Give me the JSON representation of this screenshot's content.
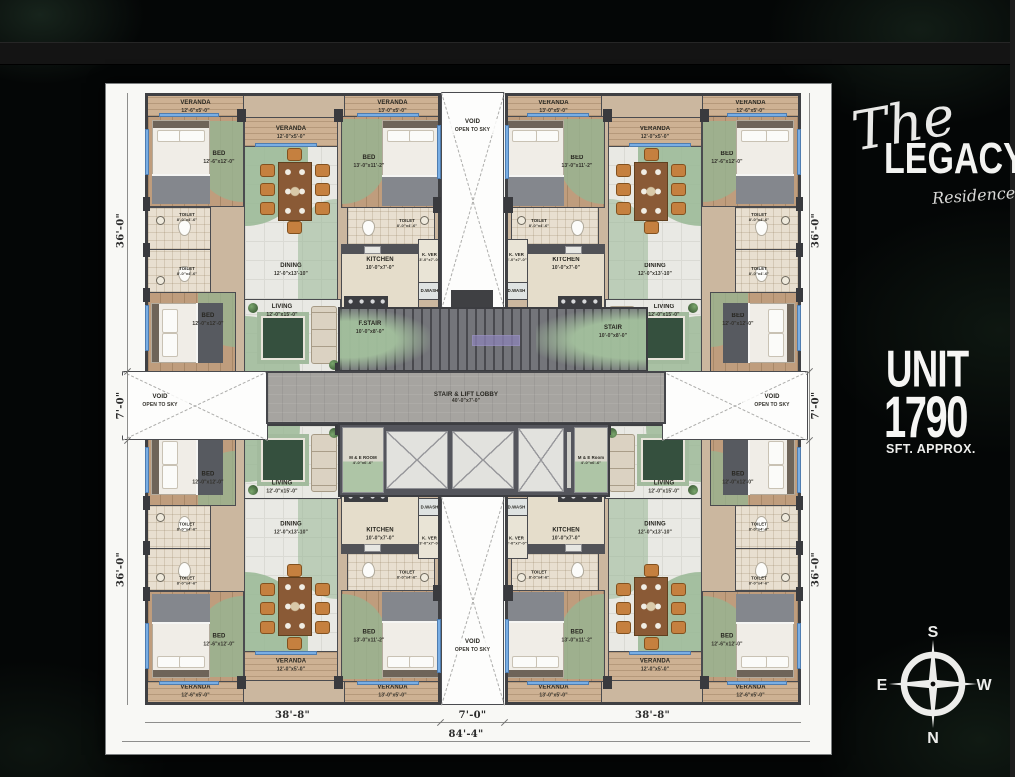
{
  "branding": {
    "logo_the": "The",
    "logo_main": "LEGACY",
    "logo_sub": "Residence",
    "unit_word": "UNIT",
    "unit_number": "1790",
    "unit_sub": "SFT. APPROX.",
    "compass": {
      "top": "S",
      "bottom": "N",
      "left": "E",
      "right": "W"
    }
  },
  "rooms": {
    "veranda1": {
      "name": "VERANDA",
      "dim": "12'-6\"x5'-0\""
    },
    "veranda2": {
      "name": "VERANDA",
      "dim": "12'-0\"x5'-0\""
    },
    "veranda3": {
      "name": "VERANDA",
      "dim": "13'-0\"x5'-0\""
    },
    "bed1": {
      "name": "BED",
      "dim": "12'-6\"x12'-0\""
    },
    "bed2": {
      "name": "BED",
      "dim": "12'-0\"x12'-0\""
    },
    "bed3": {
      "name": "BED",
      "dim": "13'-0\"x11'-2\""
    },
    "toilet": {
      "name": "TOILET",
      "dim": "8'-0\"x4'-6\""
    },
    "dining": {
      "name": "DINING",
      "dim": "12'-0\"x13'-10\""
    },
    "living": {
      "name": "LIVING",
      "dim": "12'-0\"x15'-0\""
    },
    "kitchen": {
      "name": "KITCHEN",
      "dim": "10'-0\"x7'-0\""
    },
    "kver": {
      "name": "K. VER",
      "dim": "3'-0\"x7'-0\""
    },
    "dwash": {
      "name": "D.WASH"
    }
  },
  "core": {
    "lobby": {
      "name": "STAIR & LIFT LOBBY",
      "dim": "40'-0\"x7'-0\""
    },
    "fstair": {
      "name": "F.STAIR",
      "dim": "10'-0\"x8'-0\""
    },
    "stair": {
      "name": "STAIR",
      "dim": "10'-0\"x8'-0\""
    },
    "me_left": {
      "name": "M & E ROOM",
      "dim": "4'-0\"x6'-6\""
    },
    "me_right": {
      "name": "M & E Room",
      "dim": "4'-0\"x6'-6\""
    },
    "void_line1": "VOID",
    "void_line2": "OPEN TO SKY"
  },
  "dimensions": {
    "left_top": "36'-0\"",
    "left_mid": "7'-0\"",
    "left_bottom": "36'-0\"",
    "right_top": "36'-0\"",
    "right_mid": "7'-0\"",
    "right_bottom": "36'-0\"",
    "bottom_left": "38'-8\"",
    "bottom_mid": "7'-0\"",
    "bottom_right": "38'-8\"",
    "bottom_total": "84'-4\""
  }
}
